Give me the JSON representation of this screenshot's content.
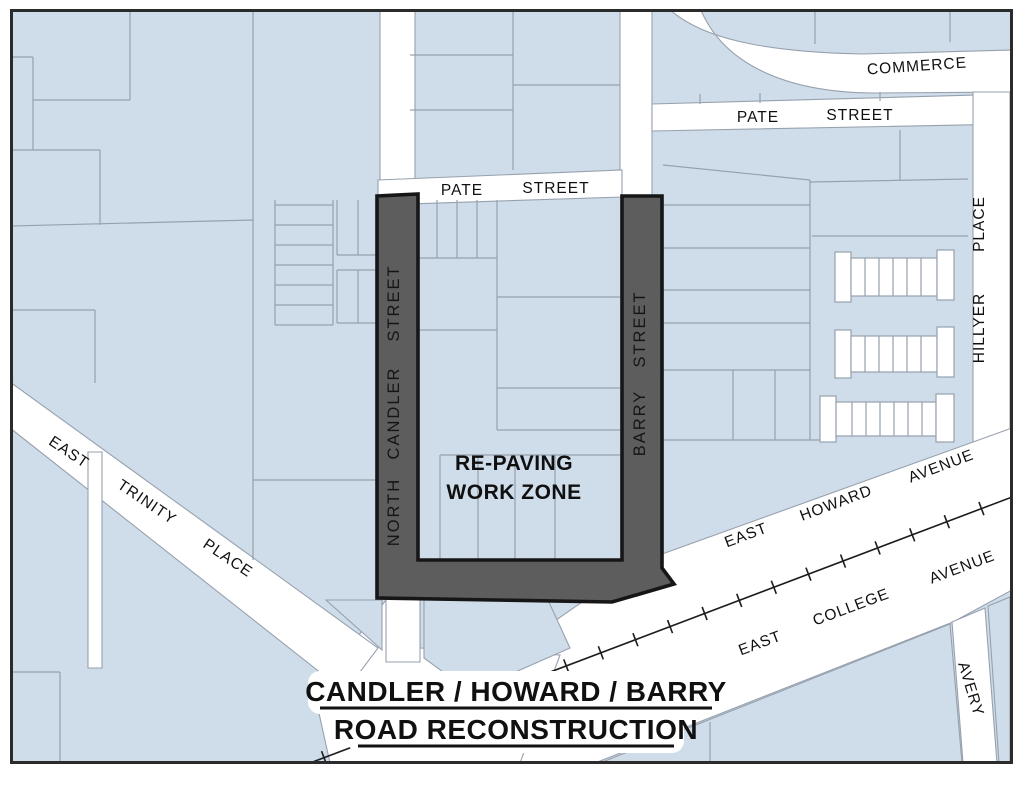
{
  "title": {
    "line1": "CANDLER / HOWARD / BARRY",
    "line2": "ROAD RECONSTRUCTION"
  },
  "work_zone": {
    "line1": "RE-PAVING",
    "line2": "WORK ZONE"
  },
  "streets": {
    "commerce": "COMMERCE",
    "pate_upper": {
      "w1": "PATE",
      "w2": "STREET"
    },
    "pate_lower": {
      "w1": "PATE",
      "w2": "STREET"
    },
    "hillyer": {
      "w1": "HILLYER",
      "w2": "PLACE"
    },
    "north_candler": {
      "w1": "NORTH",
      "w2": "CANDLER",
      "w3": "STREET"
    },
    "barry": {
      "w1": "BARRY",
      "w2": "STREET"
    },
    "east_trinity": {
      "w1": "EAST",
      "w2": "TRINITY",
      "w3": "PLACE"
    },
    "east_howard": {
      "w1": "EAST",
      "w2": "HOWARD",
      "w3": "AVENUE"
    },
    "east_college": {
      "w1": "EAST",
      "w2": "COLLEGE",
      "w3": "AVENUE"
    },
    "avery": "AVERY"
  },
  "colors": {
    "parcel": "#cfdcea",
    "street": "#ffffff",
    "outline": "#97a1ad",
    "work_zone": "#5d5d5d",
    "zone_border": "#161616",
    "ink": "#101010",
    "frame": "#2b2b2b",
    "rail": "#1c1c1c"
  }
}
